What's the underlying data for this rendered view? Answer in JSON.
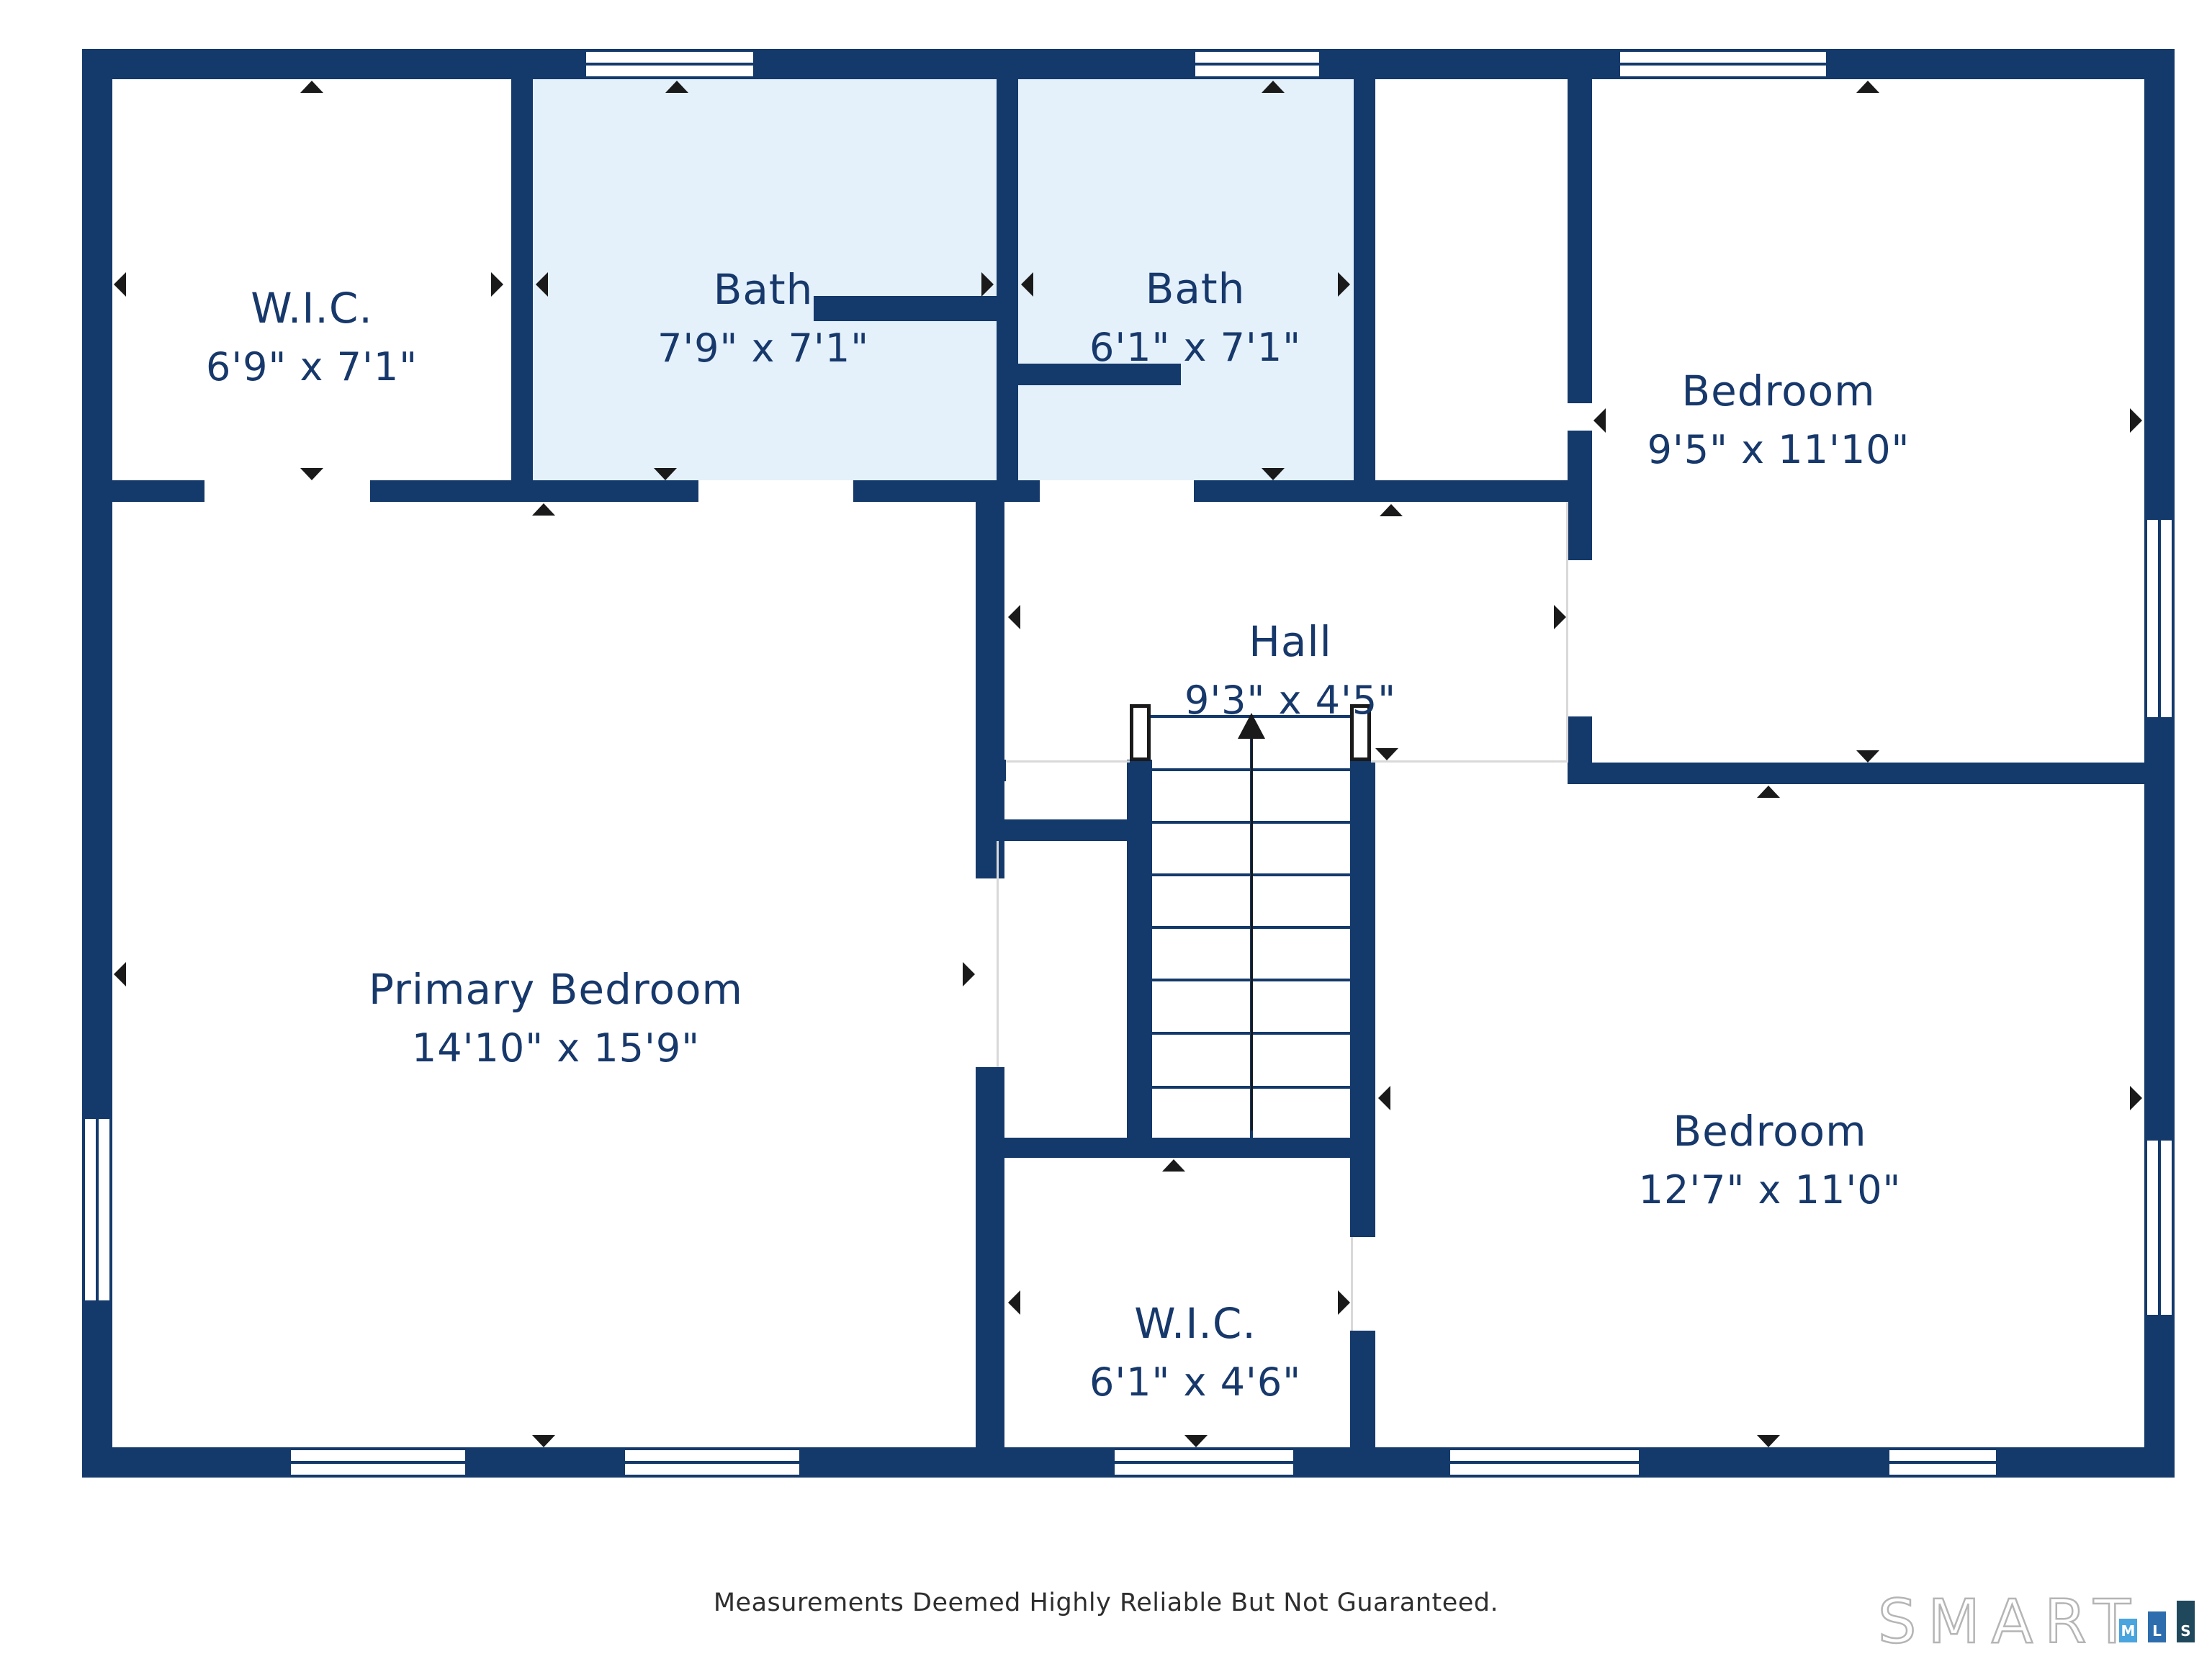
{
  "floorplan": {
    "rooms": [
      {
        "id": "wic-top",
        "name": "W.I.C.",
        "dims": "6'9\" x 7'1\""
      },
      {
        "id": "bath-1",
        "name": "Bath",
        "dims": "7'9\" x 7'1\""
      },
      {
        "id": "bath-2",
        "name": "Bath",
        "dims": "6'1\" x 7'1\""
      },
      {
        "id": "bedroom-top-right",
        "name": "Bedroom",
        "dims": "9'5\" x 11'10\""
      },
      {
        "id": "hall",
        "name": "Hall",
        "dims": "9'3\" x 4'5\""
      },
      {
        "id": "primary-bedroom",
        "name": "Primary Bedroom",
        "dims": "14'10\" x 15'9\""
      },
      {
        "id": "bedroom-bottom-right",
        "name": "Bedroom",
        "dims": "12'7\" x 11'0\""
      },
      {
        "id": "wic-bottom",
        "name": "W.I.C.",
        "dims": "6'1\" x 4'6\""
      }
    ],
    "colors": {
      "wall": "#14396B",
      "bath_fill": "#E4F1FB",
      "label_text": "#17386B",
      "floor_line": "#D9D9D9",
      "marker": "#1A1A1A"
    },
    "footer": {
      "disclaimer": "Measurements Deemed Highly Reliable But Not Guaranteed."
    },
    "logo": {
      "word": "SMART",
      "blocks": [
        {
          "letter": "M",
          "color": "#4AA4DE"
        },
        {
          "letter": "L",
          "color": "#2D6DAE"
        },
        {
          "letter": "S",
          "color": "#1F485C"
        }
      ]
    }
  }
}
